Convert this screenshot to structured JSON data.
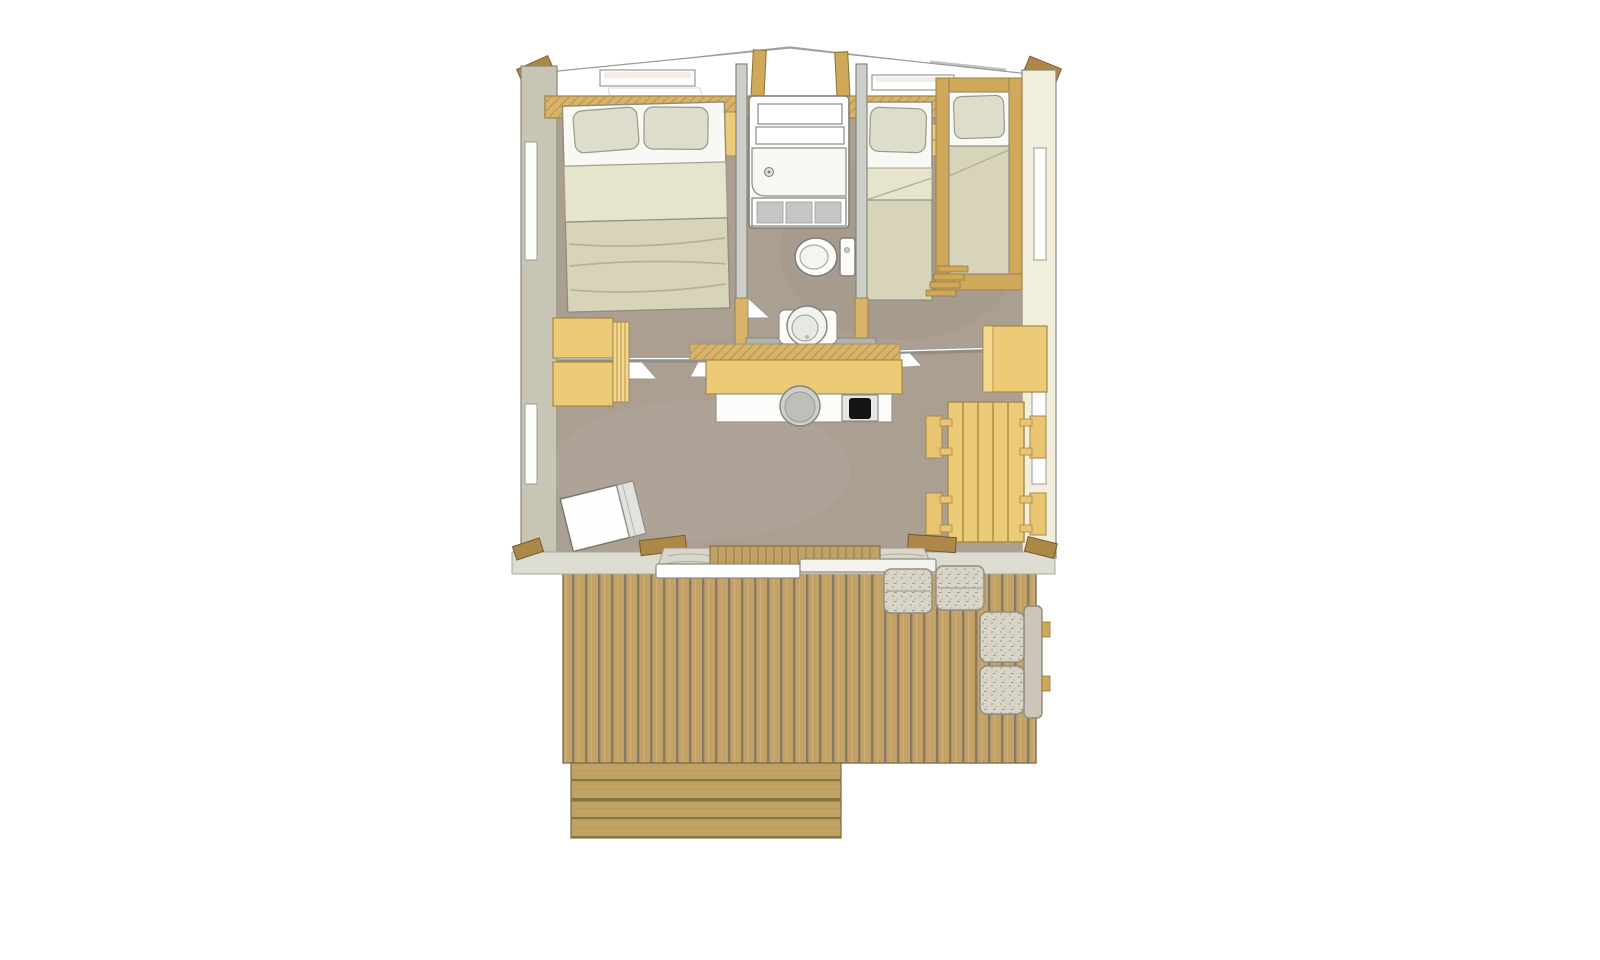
{
  "meta": {
    "description": "Top-down architectural floor plan rendering of a small cabin / safari-lodge unit with a front wooden terrace. No text labels are rendered in the image.",
    "canvas": {
      "width": 1600,
      "height": 960
    }
  },
  "palette": {
    "background": "#ffffff",
    "roof_line": "#a7a7a1",
    "roof_line_faint": "#cbcbc6",
    "ceiling_white": "#ffffff",
    "ceiling_stroke": "#9b9b95",
    "shelf_wood": "#d9b369",
    "wood_frame": "#cfa85a",
    "wood_dark": "#ac8748",
    "wood_stroke": "#7d6434",
    "wall_left": "#c9c5b5",
    "wall_right": "#f1eedb",
    "wall_stroke": "#8a887c",
    "window_white": "#fdfdfc",
    "floor": "#ab9f92",
    "partition": "#cfcfca",
    "partition_stroke": "#868680",
    "bedding_white": "#f8f8f4",
    "pillow": "#deddcc",
    "blanket": "#d8d4b9",
    "blanket_light": "#e7e4cd",
    "bed_stroke": "#8f8d7e",
    "fixture_white": "#fcfcfa",
    "fixture_stroke": "#7e7d77",
    "glass_grey": "#c6c6c4",
    "basin_ledge": "#b5b2a8",
    "furniture_yellow": "#eccb76",
    "furniture_yellow_light": "#f3d88e",
    "furniture_stroke": "#a5874a",
    "hob_black": "#141414",
    "sink_grey": "#cfcfca",
    "rail_grey": "#8e8e86",
    "deck_plank": "#c4a267",
    "deck_gap": "#7e7666",
    "deck_stroke": "#77704f",
    "step_wood": "#c2a164",
    "sill": "#dcdcd0",
    "sill_stroke": "#a8a89c",
    "doormat": "#d9d6c9",
    "fabric": "#d8d4c6",
    "fabric_back": "#cbc6b7",
    "fabric_stroke": "#8f8b7f"
  },
  "scene": {
    "rooms": [
      {
        "name": "bedroom-left",
        "furniture": [
          "double-bed",
          "two-pillows",
          "nightstand",
          "wardrobe",
          "side-window",
          "roof-window"
        ]
      },
      {
        "name": "bathroom",
        "furniture": [
          "shower-cabin",
          "toilet",
          "round-washbasin"
        ]
      },
      {
        "name": "bedroom-right",
        "furniture": [
          "single-bed",
          "framed-single-bed",
          "ladder",
          "side-window",
          "roof-window"
        ]
      },
      {
        "name": "living-area",
        "furniture": [
          "kitchen-counter",
          "round-sink",
          "hob",
          "storage-cabinet",
          "dining-table",
          "four-chairs",
          "cooler-box",
          "curtain-rail",
          "side-windows"
        ]
      },
      {
        "name": "terrace",
        "furniture": [
          "plank-deck",
          "two-steps",
          "two-poufs",
          "outdoor-sofa",
          "doormats",
          "sliding-door",
          "timber-posts"
        ]
      }
    ],
    "counts": {
      "pillows": 4,
      "beds": 3,
      "chairs": 4,
      "poufs": 2,
      "deck_steps": 2,
      "side_windows": 4,
      "roof_windows": 2,
      "sliding_door_panels": 2
    }
  }
}
